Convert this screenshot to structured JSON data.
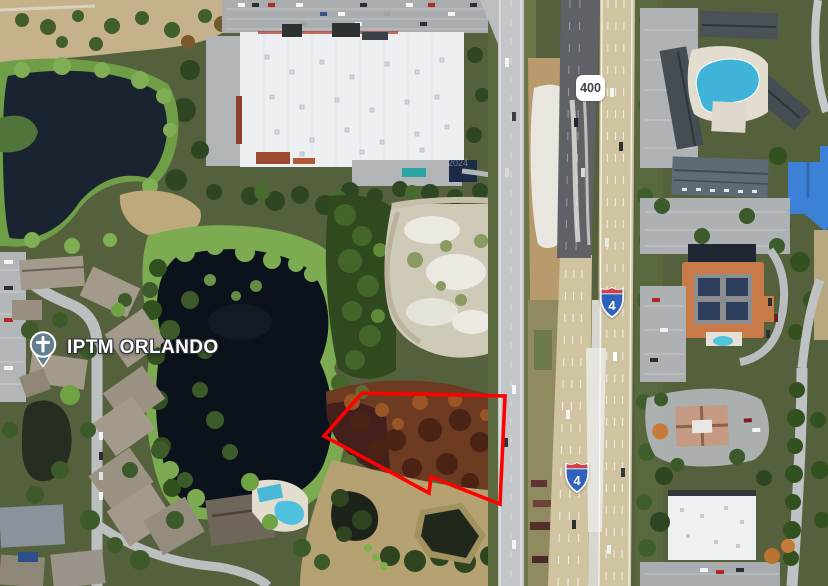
{
  "map": {
    "canvas": {
      "width": 828,
      "height": 586,
      "view": "satellite"
    },
    "place_label": {
      "name": "IPTM ORLANDO",
      "icon": "church-pin",
      "icon_color": "#64808f"
    },
    "shields": {
      "state_route": {
        "text": "400"
      },
      "interstate_north": {
        "text": "4"
      },
      "interstate_south": {
        "text": "4"
      }
    },
    "watermark": {
      "text": "2024"
    },
    "property_boundary": {
      "stroke": "#ff0000",
      "stroke_width": 3.6,
      "points": "324,436 362,393 505,396 500,504 431,477 429,493"
    }
  }
}
